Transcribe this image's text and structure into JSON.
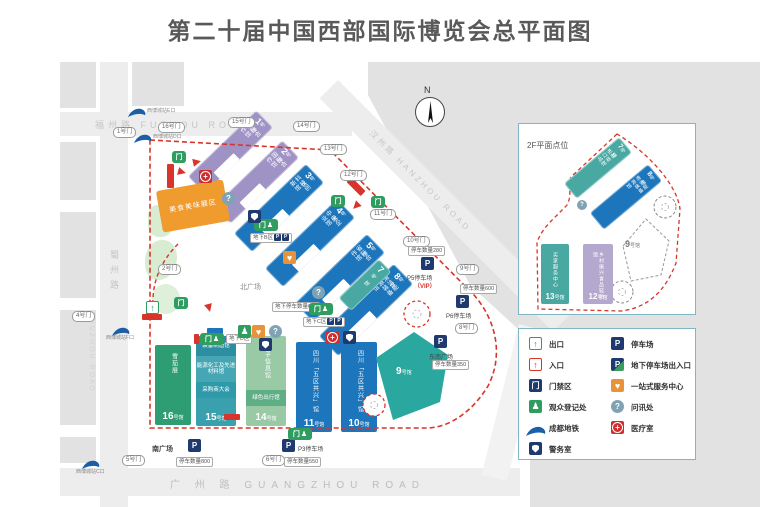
{
  "title": "第二十届中国西部国际博览会总平面图",
  "compass_n": "N",
  "icons": {
    "p": "P",
    "plus": "+",
    "q": "?",
    "door": "门",
    "person": "♟",
    "heart": "♥",
    "arrow": "↑"
  },
  "roads": {
    "fuzhou": "福州路 FUZHOU ROAD",
    "shuzhou_cn": "蜀州路",
    "shuzhou_en": "SHUZHOU ROAD",
    "hanzhou": "汉州路 HANZHOU ROAD",
    "guangzhou": "广 州 路  GUANGZHOU ROAD"
  },
  "plazas": {
    "north": "北广场",
    "south": "南广场",
    "southeast": "东南广场"
  },
  "halls": {
    "h1": {
      "no": "1",
      "suf": "号馆",
      "name": "国际合作馆"
    },
    "h2": {
      "no": "2",
      "suf": "号馆",
      "name": "国际合作馆"
    },
    "h3": {
      "no": "3",
      "suf": "号馆",
      "name": "科技创新馆"
    },
    "h4": {
      "no": "4",
      "suf": "号馆",
      "name": "中央企业馆"
    },
    "h5": {
      "no": "5",
      "suf": "号馆",
      "name": "省际合作馆"
    },
    "h7": {
      "no": "7",
      "suf": "号馆",
      "name": ""
    },
    "h8": {
      "no": "8",
      "suf": "号馆",
      "name": "清洁能源装备馆"
    },
    "h9": {
      "no": "9",
      "suf": "号馆"
    },
    "h10": {
      "no": "10",
      "suf": "号馆",
      "name": "四川「五区共兴」馆"
    },
    "h11": {
      "no": "11",
      "suf": "号馆",
      "name": "四川「五区共兴」馆"
    },
    "h14": {
      "no": "14",
      "suf": "号馆",
      "name": "电子信息馆",
      "band": "绿色出行馆"
    },
    "h15": {
      "no": "15",
      "suf": "号馆",
      "s1": "装备制造馆",
      "s2": "能源化工及先进材料馆",
      "s3": "采购商大会"
    },
    "h16": {
      "no": "16",
      "suf": "号馆",
      "name": "雪茄展"
    },
    "food": "美食美味展区"
  },
  "inset": {
    "title": "2F平面点位",
    "h7": {
      "no": "7",
      "suf": "号馆",
      "name": "进出口商品馆"
    },
    "h8": {
      "no": "8",
      "suf": "号馆",
      "name": "清洁能源装备馆"
    },
    "h9": {
      "no": "9",
      "suf": "号馆"
    },
    "h12": {
      "no": "12",
      "suf": "号馆",
      "name": "乡村振兴食品轻纺馆"
    },
    "h13": {
      "no": "13",
      "suf": "号馆",
      "name": "买家服务中心"
    }
  },
  "gates": {
    "g1": "1号门",
    "g2": "2号门",
    "g4": "4号门",
    "g5": "5号门",
    "g6": "6号门",
    "g8": "8号门",
    "g9": "9号门",
    "g10": "10号门",
    "g11": "11号门",
    "g12": "12号门",
    "g13": "13号门",
    "g14": "14号门",
    "g15": "15号门",
    "g16": "16号门"
  },
  "parking": {
    "p5": {
      "name": "P5停车场",
      "vip": "（VIP）",
      "count": "停车数量280"
    },
    "p6": {
      "name": "P6停车场",
      "count": "停车数量600"
    },
    "p3": {
      "name": "P3停车场",
      "count": "停车数量550"
    },
    "south_count": "停车数量800",
    "se_count": "停车数量350",
    "underground": "地下停车数量600",
    "zone_b": "地下B区",
    "zone_c": "地下C区",
    "zone_d": "地下D区"
  },
  "metro": {
    "e": "西博城站E口",
    "d": "西博城站D口",
    "f": "西博城站F口",
    "c": "西博城站C口"
  },
  "legend": {
    "exit": "出口",
    "entrance": "入口",
    "gate_zone": "门禁区",
    "register": "观众登记处",
    "metro": "成都地铁",
    "police": "警务室",
    "parking": "停车场",
    "underground_parking": "地下停车场出入口",
    "onestop": "一站式服务中心",
    "info": "问讯处",
    "medical": "医疗室"
  }
}
